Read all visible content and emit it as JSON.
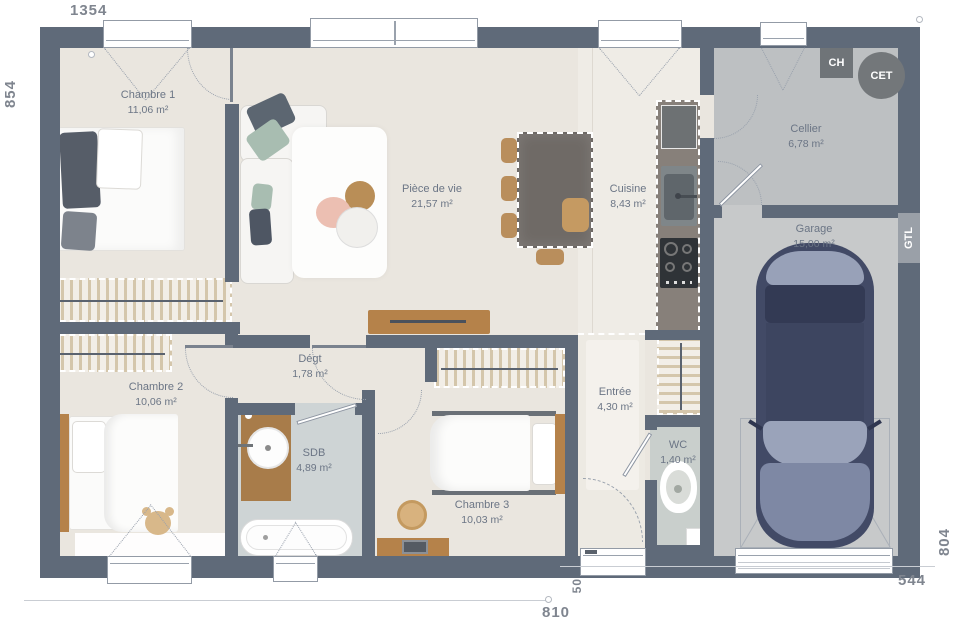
{
  "plan": {
    "rooms": {
      "chambre1": {
        "name": "Chambre 1",
        "area": "11,06 m²"
      },
      "piece_de_vie": {
        "name": "Pièce de vie",
        "area": "21,57 m²"
      },
      "cuisine": {
        "name": "Cuisine",
        "area": "8,43 m²"
      },
      "cellier": {
        "name": "Cellier",
        "area": "6,78 m²"
      },
      "garage": {
        "name": "Garage",
        "area": "15,00 m²"
      },
      "chambre2": {
        "name": "Chambre 2",
        "area": "10,06 m²"
      },
      "degagement": {
        "name": "Dégt",
        "area": "1,78 m²"
      },
      "sdb": {
        "name": "SDB",
        "area": "4,89 m²"
      },
      "chambre3": {
        "name": "Chambre 3",
        "area": "10,03 m²"
      },
      "entree": {
        "name": "Entrée",
        "area": "4,30 m²"
      },
      "wc": {
        "name": "WC",
        "area": "1,40 m²"
      }
    },
    "equipment": {
      "ch": "CH",
      "cet": "CET",
      "gtl": "GTL"
    },
    "dimensions": {
      "top_width": "1354",
      "left_height": "854",
      "right_height": "804",
      "bottom_right_width": "544",
      "bottom_left_width": "810",
      "entry_offset": "50"
    },
    "colors": {
      "wall": "#5f6a79",
      "floor_living": "#eae6df",
      "floor_cellier": "#bdc0c2",
      "floor_garage": "#c7c9ca",
      "floor_sdb": "#ced4d5",
      "label_text": "#6b7585"
    }
  }
}
